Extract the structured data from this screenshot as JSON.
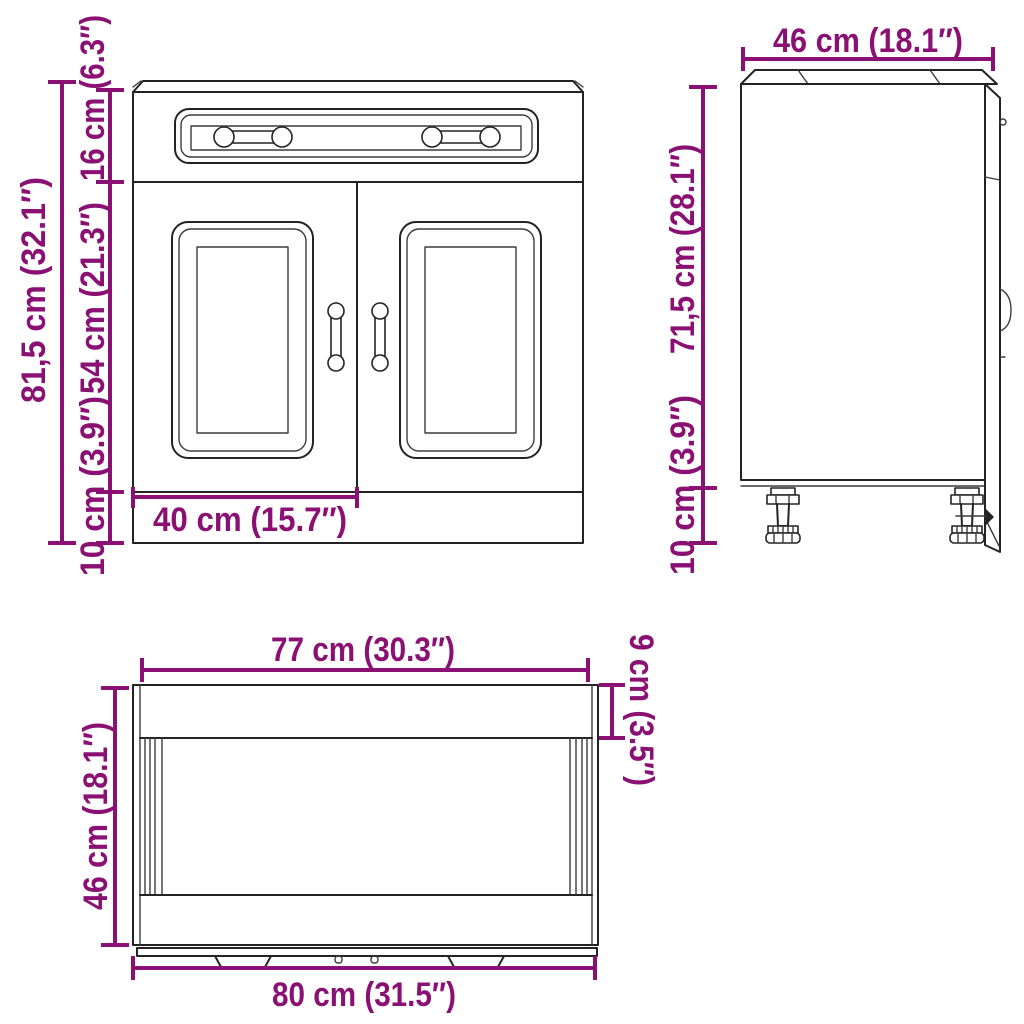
{
  "style": {
    "dimension_color": "#8a1173",
    "line_color": "#232323",
    "background": "#ffffff"
  },
  "views": {
    "front_view": {
      "labels": {
        "total_height": "81,5 cm (32.1″)",
        "drawer_section_height": "16 cm (6.3″)",
        "door_section_height": "54 cm (21.3″)",
        "plinth_height": "10 cm (3.9″)",
        "door_width": "40 cm (15.7″)"
      }
    },
    "side_view": {
      "labels": {
        "depth": "46 cm (18.1″)",
        "carcass_height": "71,5 cm (28.1″)",
        "leg_height": "10 cm (3.9″)"
      }
    },
    "top_view": {
      "labels": {
        "carcass_width": "77 cm (30.3″)",
        "back_offset_depth": "9 cm (3.5″)",
        "depth": "46 cm (18.1″)",
        "total_width": "80 cm (31.5″)"
      }
    }
  }
}
